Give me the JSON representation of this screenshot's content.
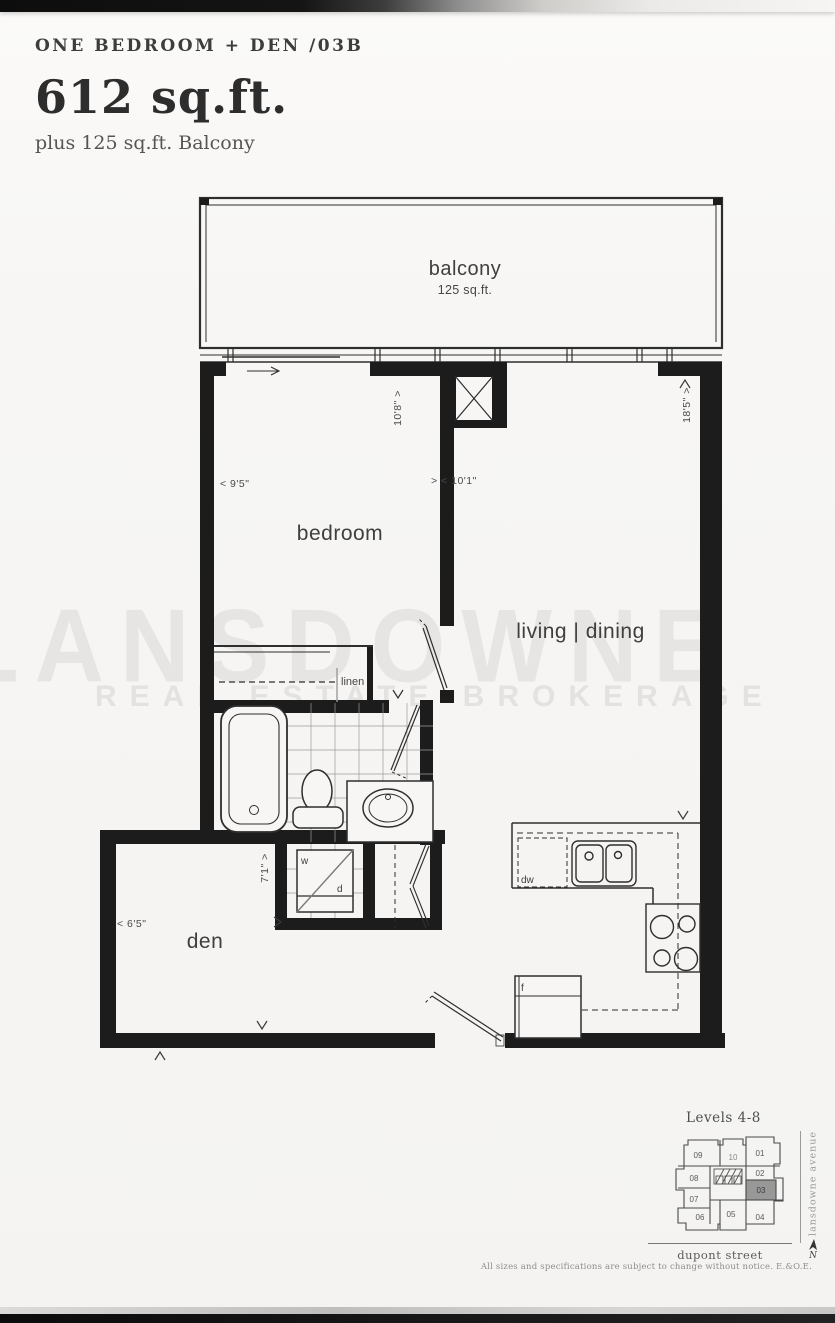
{
  "header": {
    "plan_code": "ONE BEDROOM + DEN /03B",
    "area": "612 sq.ft.",
    "balcony_note": "plus 125 sq.ft. Balcony"
  },
  "rooms": {
    "balcony_label": "balcony",
    "balcony_area": "125 sq.ft.",
    "bedroom": "bedroom",
    "living_dining": "living | dining",
    "den": "den",
    "linen": "linen"
  },
  "fixtures": {
    "washer": "w",
    "dryer": "d",
    "dishwasher": "dw",
    "fridge": "f"
  },
  "dimensions": {
    "bedroom_width": "< 9'5\"",
    "bedroom_depth": "10'8\" >",
    "living_width": "> < 10'1\"",
    "living_depth": "18'5\" >",
    "hall_depth": "7'1\" >",
    "den_width": "< 6'5\""
  },
  "keyplan": {
    "title": "Levels 4-8",
    "street_right": "lansdowne avenue",
    "street_bottom": "dupont street",
    "north_label": "N",
    "highlighted_unit": "03",
    "units": [
      "09",
      "10",
      "01",
      "08",
      "02",
      "03",
      "07",
      "06",
      "05",
      "04"
    ]
  },
  "footer": {
    "disclaimer": "All sizes and specifications are subject to change without notice. E.&O.E."
  },
  "watermark": {
    "line1": "LANSDOWNE",
    "line2": "REAL ESTATE BROKERAGE",
    "side_text": "condominiums"
  },
  "colors": {
    "wall": "#1c1c1c",
    "line": "#2e2e2e",
    "unit_highlight": "#989898"
  }
}
